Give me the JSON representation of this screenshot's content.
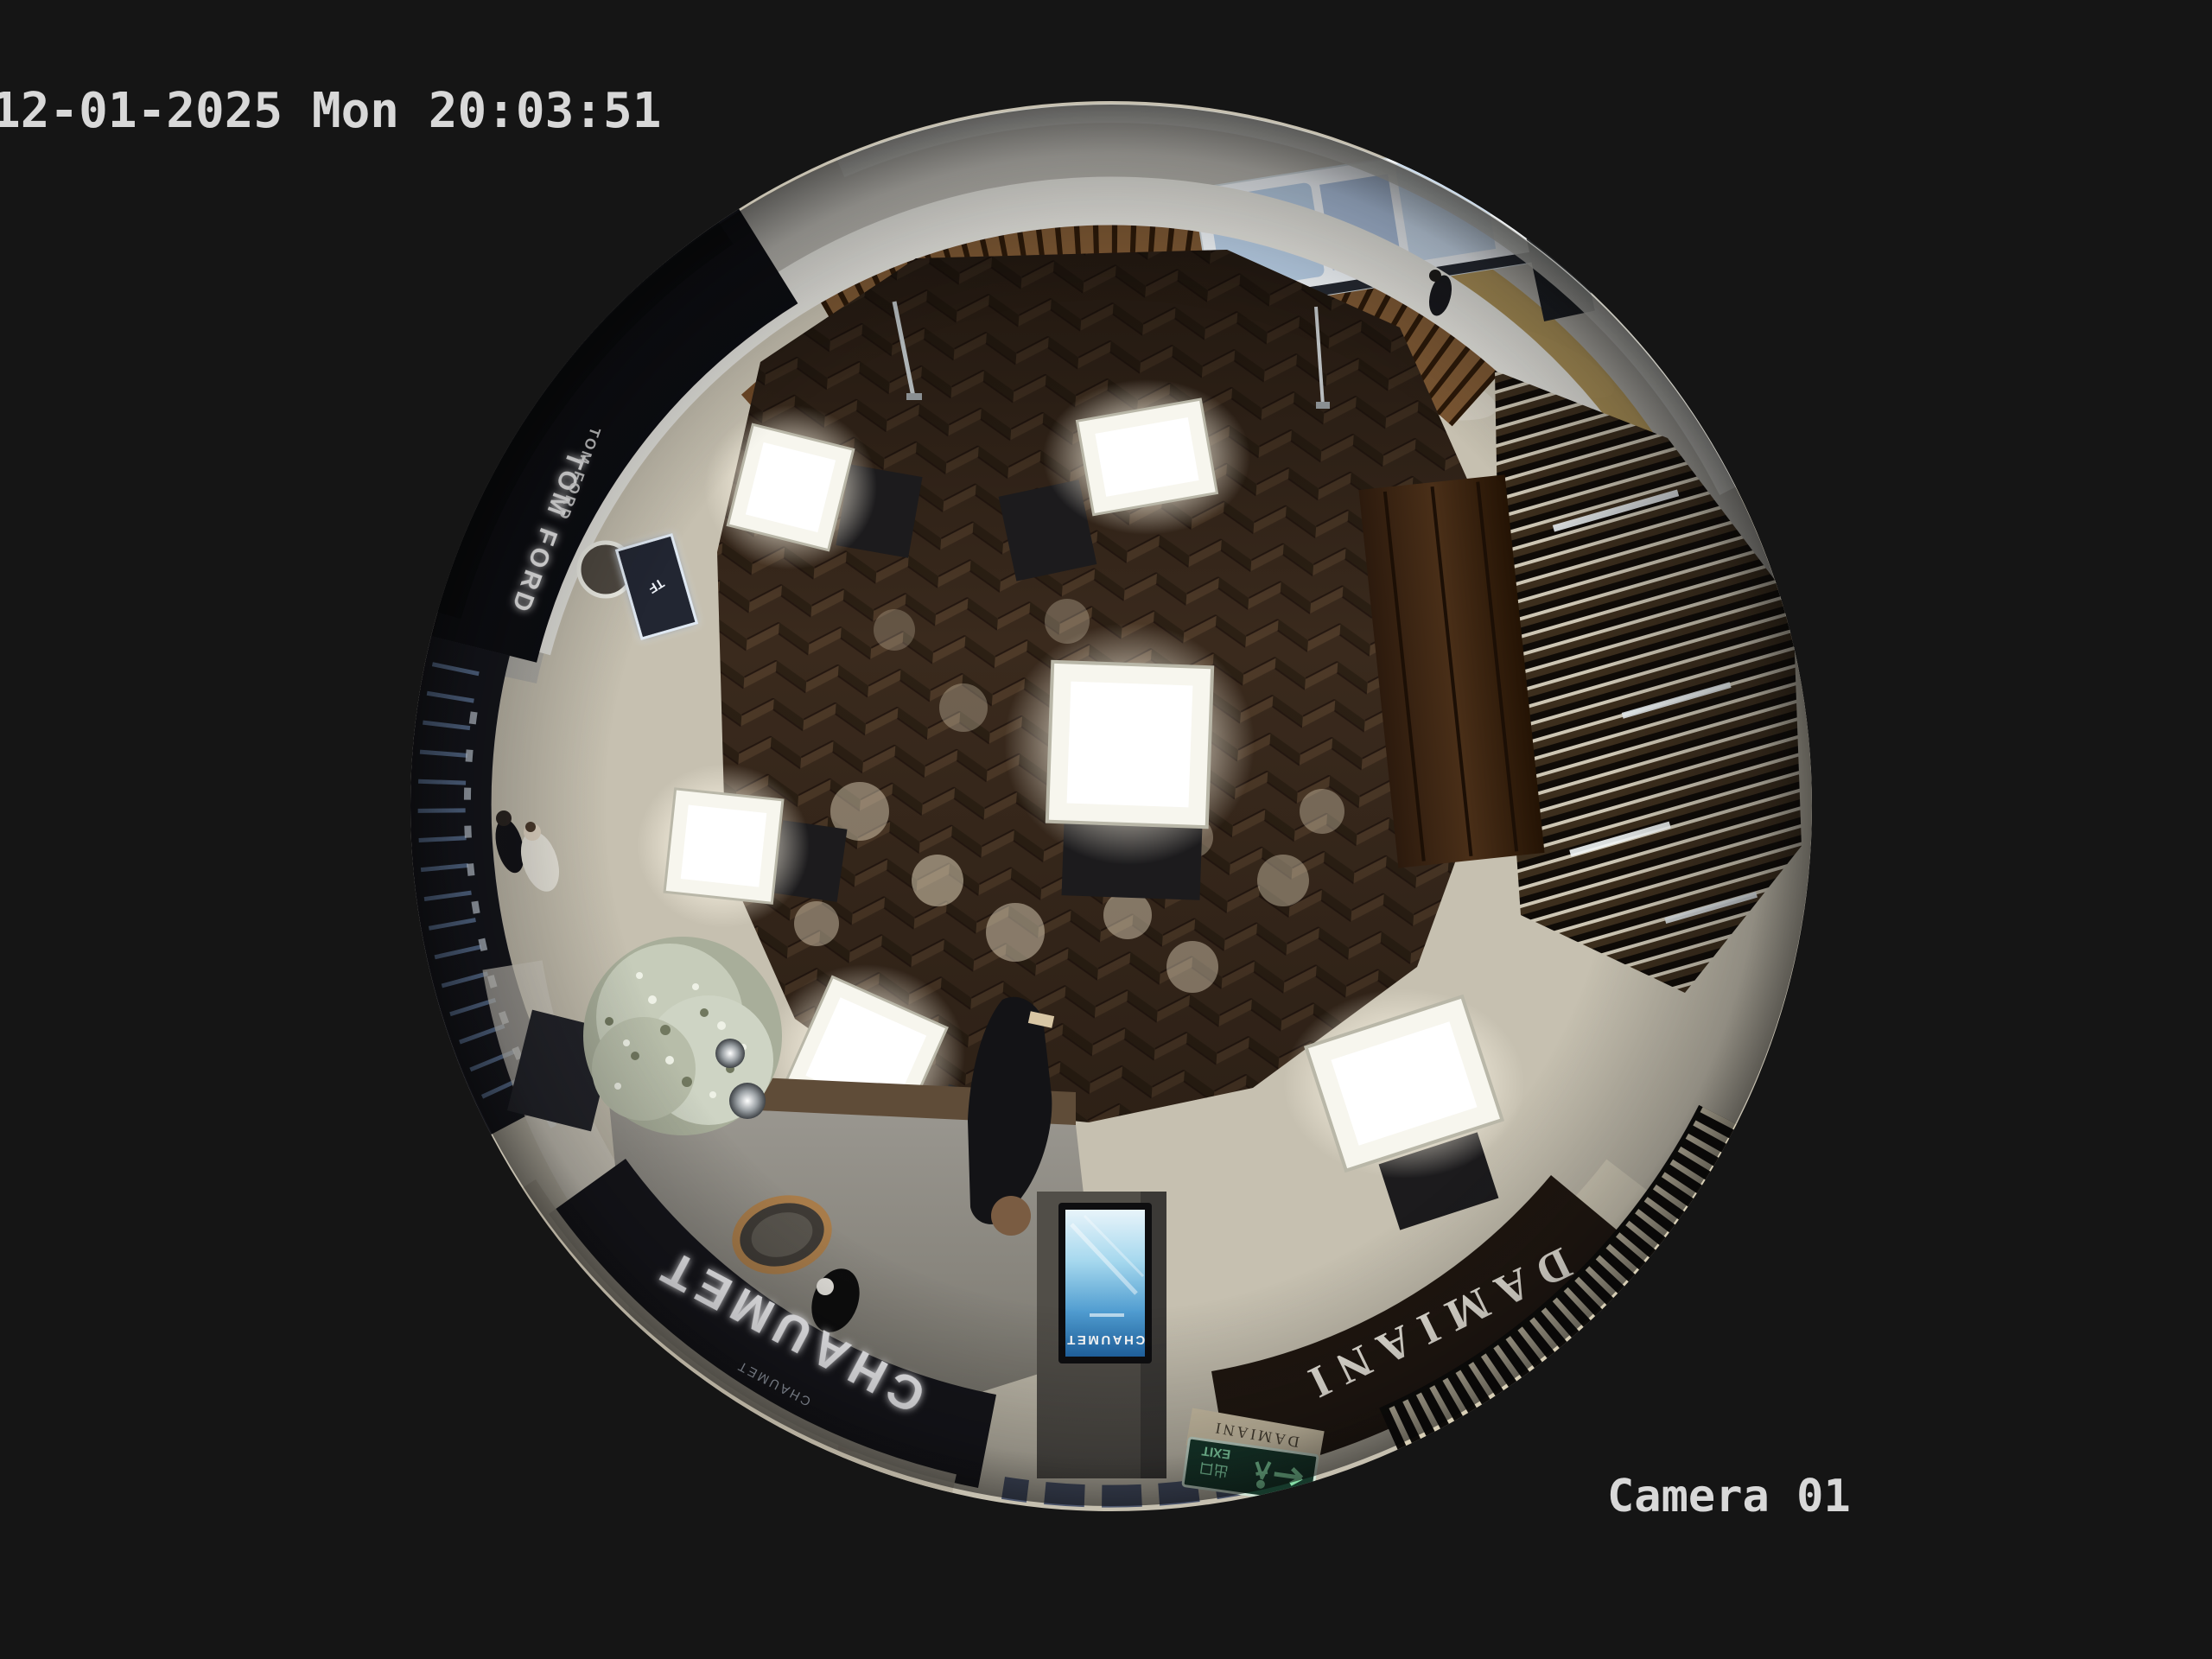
{
  "osd": {
    "timestamp": "12-01-2025 Mon 20:03:51",
    "camera_label": "Camera 01",
    "text_color": "#d8d8d8",
    "background": "#151515"
  },
  "scene": {
    "description": "overhead fisheye view of luxury jewelry boutique in mall",
    "store_signs": {
      "tom_ford": "TOM FORD",
      "chaumet": "CHAUMET",
      "chaumet_sub": "CHAUMET",
      "chaumet_screen": "CHAUMET",
      "damiani": "DAMIANI",
      "damiani_board": "DAMIANI",
      "tf_logo": "TF",
      "exit_cn": "出口",
      "exit_en": "EXIT"
    },
    "colors": {
      "wood_floor": "#3a2a1d",
      "marble_corridor": "#b8b5ac",
      "walkway": "#c6c0b0",
      "chaumet_fascia": "#15151a",
      "damiani_fascia": "#201710",
      "led_warm": "#ffd894",
      "screen_blue": "#4f9cd0",
      "exit_green": "#16392b",
      "case_glow": "#ffffff"
    }
  }
}
